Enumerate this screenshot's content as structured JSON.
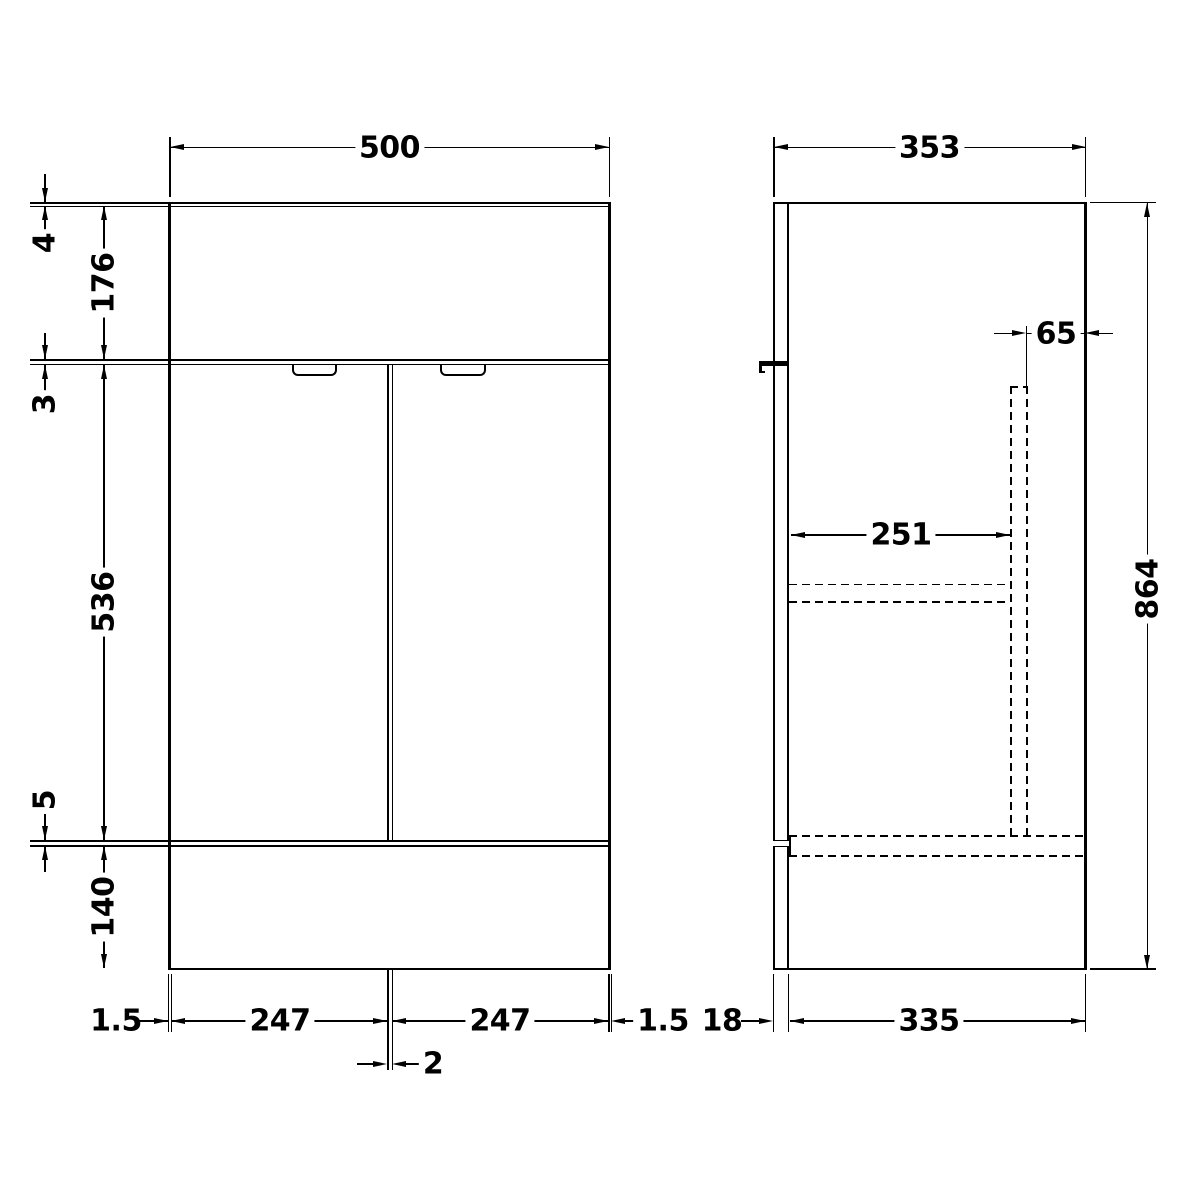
{
  "front_view": {
    "overall_width": "500",
    "countertop_thickness": "4",
    "apron_height": "176",
    "top_gap": "3",
    "door_height": "536",
    "bottom_gap": "5",
    "plinth_height": "140",
    "left_reveal": "1.5",
    "left_door_width": "247",
    "door_gap": "2",
    "right_door_width": "247",
    "right_reveal": "1.5"
  },
  "side_view": {
    "overall_depth": "353",
    "overall_height": "864",
    "rear_void_width": "65",
    "internal_depth": "251",
    "door_thickness": "18",
    "carcass_depth": "335"
  }
}
